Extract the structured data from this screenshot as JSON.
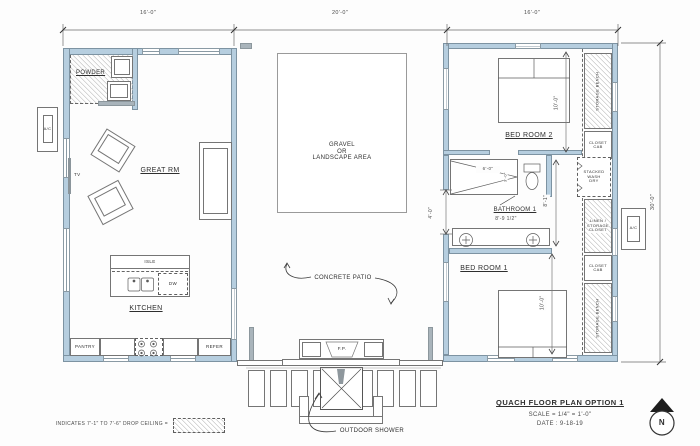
{
  "colors": {
    "wall_fill": "#b6cedf",
    "line_color": "#555555",
    "hatch_color": "#c9c9c9"
  },
  "dims": {
    "seg1": "16'-0\"",
    "seg2": "20'-0\"",
    "seg3": "16'-0\"",
    "height": "30'-0\"",
    "br2_depth": "10'-0\"",
    "br1_depth": "10'-0\"",
    "bath_height": "8'-1\"",
    "bath_width": "8'-9 1/2\"",
    "hall": "4'-0\"",
    "shower_width": "6'-0\"",
    "shower_depth": "3'-0\""
  },
  "left_wing": {
    "powder": "POWDER",
    "great_rm": "GREAT RM",
    "tv": "TV",
    "kitchen": "KITCHEN",
    "isle": "ISLE",
    "dw": "DW",
    "pantry": "PANTRY",
    "refer": "REFER"
  },
  "exterior": {
    "ac": "A/C",
    "gravel_line1": "GRAVEL",
    "gravel_line2": "OR",
    "gravel_line3": "LANDSCAPE AREA",
    "concrete_patio": "CONCRETE PATIO",
    "fp": "F.P.",
    "outdoor_shower": "OUTDOOR SHOWER"
  },
  "right_wing": {
    "bedroom2": "BED ROOM 2",
    "bedroom1": "BED ROOM 1",
    "bathroom1": "BATHROOM 1",
    "storage_bench": "STORAGE BENCH",
    "closet_line1": "CLOSET",
    "closet_line2": "CAB",
    "stacked_line1": "STACKED",
    "stacked_line2": "WASH",
    "stacked_line3": "DRY",
    "linen_line1": "LINEN /",
    "linen_line2": "STORAGE",
    "linen_line3": "CLOSET"
  },
  "title_block": {
    "title": "QUACH FLOOR PLAN OPTION 1",
    "scale": "SCALE = 1/4\" = 1'-0\"",
    "date": "DATE : 9-18-19",
    "north": "N"
  },
  "legend": {
    "note": "INDICATES 7'-1\" TO 7'-6\" DROP CEILING ="
  }
}
